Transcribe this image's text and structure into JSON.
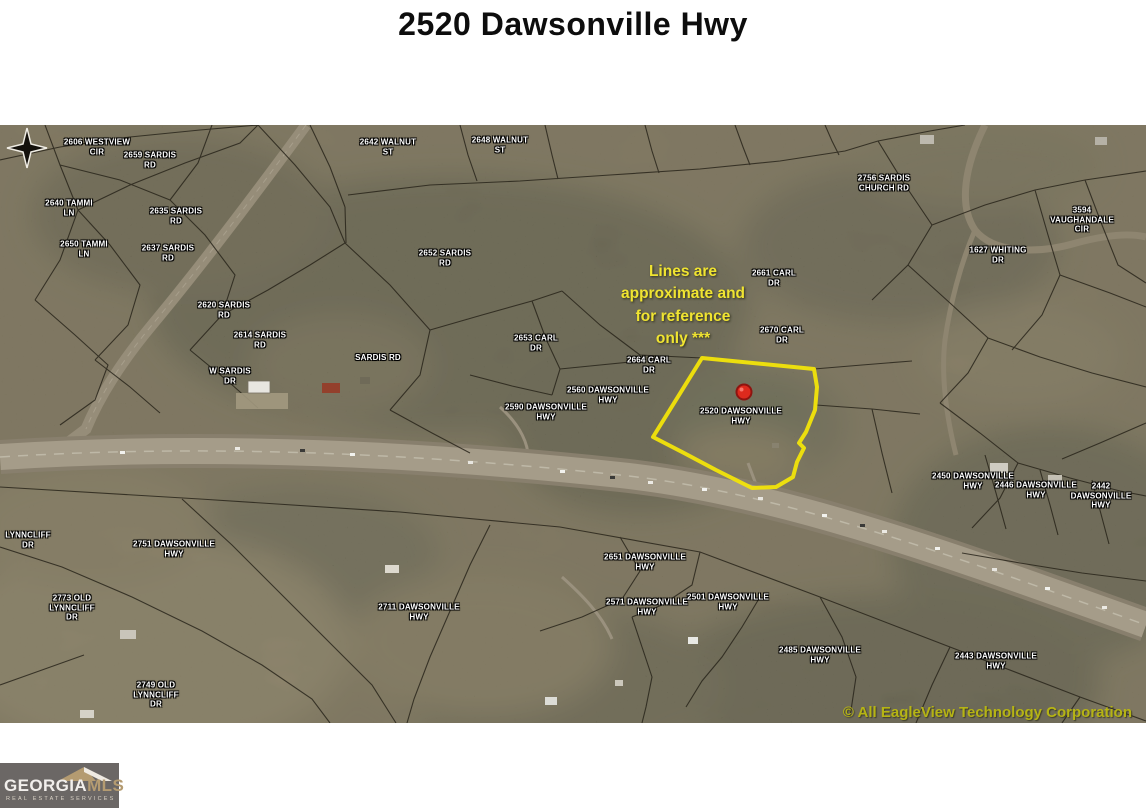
{
  "page": {
    "title": "2520 Dawsonville Hwy"
  },
  "map": {
    "note": "Lines are\napproximate and\nfor reference\nonly ***",
    "copyright": "© All EagleView Technology Corporation",
    "subject_label": "2520 DAWSONVILLE\nHWY",
    "parcel_labels": [
      {
        "text": "2606 WESTVIEW\nCIR"
      },
      {
        "text": "2659 SARDIS\nRD"
      },
      {
        "text": "2640 TAMMI\nLN"
      },
      {
        "text": "2635 SARDIS\nRD"
      },
      {
        "text": "2650 TAMMI\nLN"
      },
      {
        "text": "2637 SARDIS\nRD"
      },
      {
        "text": "2642 WALNUT\nST"
      },
      {
        "text": "2648 WALNUT\nST"
      },
      {
        "text": "2652 SARDIS\nRD"
      },
      {
        "text": "2620 SARDIS\nRD"
      },
      {
        "text": "2614 SARDIS\nRD"
      },
      {
        "text": "W SARDIS\nDR"
      },
      {
        "text": "SARDIS RD"
      },
      {
        "text": "2653 CARL\nDR"
      },
      {
        "text": "2664 CARL\nDR"
      },
      {
        "text": "2560 DAWSONVILLE\nHWY"
      },
      {
        "text": "2590 DAWSONVILLE\nHWY"
      },
      {
        "text": "2661 CARL\nDR"
      },
      {
        "text": "2670 CARL\nDR"
      },
      {
        "text": "2756 SARDIS\nCHURCH RD"
      },
      {
        "text": "3594 VAUGHANDALE\nCIR"
      },
      {
        "text": "1627 WHITING\nDR"
      },
      {
        "text": "LYNNCLIFF\nDR"
      },
      {
        "text": "2751 DAWSONVILLE\nHWY"
      },
      {
        "text": "2773 OLD\nLYNNCLIFF\nDR"
      },
      {
        "text": "2749 OLD\nLYNNCLIFF\nDR"
      },
      {
        "text": "2711 DAWSONVILLE\nHWY"
      },
      {
        "text": "2651 DAWSONVILLE\nHWY"
      },
      {
        "text": "2571 DAWSONVILLE\nHWY"
      },
      {
        "text": "2501 DAWSONVILLE\nHWY"
      },
      {
        "text": "2485 DAWSONVILLE\nHWY"
      },
      {
        "text": "2443 DAWSONVILLE\nHWY"
      },
      {
        "text": "2450 DAWSONVILLE\nHWY"
      },
      {
        "text": "2446 DAWSONVILLE\nHWY"
      },
      {
        "text": "2442 DAWSONVILLE\nHWY"
      }
    ]
  },
  "colors": {
    "property_outline": "#f2e40a",
    "marker_red": "#dd2a1d",
    "note_yellow": "#f0e431",
    "copyright_olive": "#b6b414",
    "logo_background": "#6b6765",
    "logo_tan": "#b49b71"
  },
  "icons": {
    "compass": "compass-star",
    "marker": "location-pin",
    "roof": "mls-roof"
  },
  "logo": {
    "georgia": "GEORGIA",
    "mls": "MLS",
    "tagline": "REAL ESTATE SERVICES"
  }
}
